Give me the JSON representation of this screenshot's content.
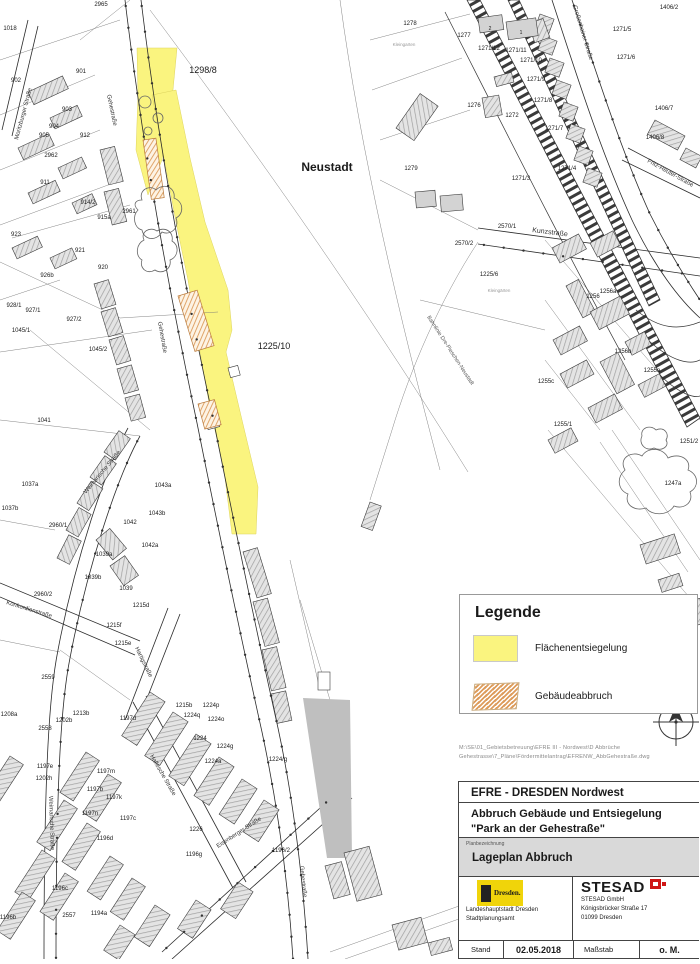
{
  "colors": {
    "yellow": "#FAF47F",
    "orange": "#DD9C5C",
    "red": "#CF1615",
    "building_gray": "#D3D3D3",
    "solid_gray": "#BFBFBF",
    "dresden_yellow": "#F0D40A"
  },
  "legend": {
    "title": "Legende",
    "items": [
      {
        "label": "Flächenentsiegelung",
        "swatch": "yellow-fill"
      },
      {
        "label": "Gebäudeabbruch",
        "swatch": "orange-hatch"
      }
    ]
  },
  "file_path": {
    "line1": "M:\\SE\\01_Gebietsbetreuung\\EFRE III - Nordwest\\D Abbrüche",
    "line2": "Gehestrasse\\7_Pläne\\Fördermittelantrag\\EFRENW_AbbGehestraße.dwg"
  },
  "title_block": {
    "project": "EFRE - DRESDEN Nordwest",
    "subject_line1": "Abbruch Gebäude und Entsiegelung",
    "subject_line2": "\"Park an der Gehestraße\"",
    "plan_caption": "Planbezeichnung",
    "plan_name": "Lageplan Abbruch",
    "dresden_logo_text": "Dresden.",
    "client_line1": "Landeshauptstadt Dresden",
    "client_line2": "Stadtplanungsamt",
    "company_logo": "STESAD",
    "company_line1": "STESAD GmbH",
    "company_line2": "Königsbrücker Straße 17",
    "company_line3": "01099 Dresden",
    "date_label": "Stand",
    "date": "02.05.2018",
    "scale_label": "Maßstab",
    "scale": "o. M."
  },
  "map": {
    "labels": [
      {
        "t": "Neustadt",
        "x": 327,
        "y": 171,
        "s": 12,
        "b": 1
      },
      {
        "t": "1298/8",
        "x": 203,
        "y": 73,
        "s": 9
      },
      {
        "t": "1225/10",
        "x": 274,
        "y": 349,
        "s": 9
      },
      {
        "t": "2965",
        "x": 101,
        "y": 6
      },
      {
        "t": "1018",
        "x": 10,
        "y": 30
      },
      {
        "t": "901",
        "x": 81,
        "y": 73
      },
      {
        "t": "902",
        "x": 16,
        "y": 82
      },
      {
        "t": "903",
        "x": 67,
        "y": 111
      },
      {
        "t": "904",
        "x": 54,
        "y": 128
      },
      {
        "t": "905",
        "x": 44,
        "y": 137
      },
      {
        "t": "912",
        "x": 85,
        "y": 137
      },
      {
        "t": "2962",
        "x": 51,
        "y": 157
      },
      {
        "t": "911",
        "x": 45,
        "y": 184
      },
      {
        "t": "914/2",
        "x": 88,
        "y": 204
      },
      {
        "t": "915a",
        "x": 104,
        "y": 219
      },
      {
        "t": "2961",
        "x": 129,
        "y": 213
      },
      {
        "t": "923",
        "x": 16,
        "y": 236
      },
      {
        "t": "921",
        "x": 80,
        "y": 252
      },
      {
        "t": "920",
        "x": 103,
        "y": 269
      },
      {
        "t": "926b",
        "x": 47,
        "y": 277
      },
      {
        "t": "928/1",
        "x": 14,
        "y": 307
      },
      {
        "t": "927/1",
        "x": 33,
        "y": 312
      },
      {
        "t": "927/2",
        "x": 74,
        "y": 321
      },
      {
        "t": "1045/1",
        "x": 21,
        "y": 332
      },
      {
        "t": "1045/2",
        "x": 98,
        "y": 351
      },
      {
        "t": "1041",
        "x": 44,
        "y": 422
      },
      {
        "t": "1037a",
        "x": 30,
        "y": 486
      },
      {
        "t": "1037b",
        "x": 10,
        "y": 510
      },
      {
        "t": "2960/1",
        "x": 58,
        "y": 527
      },
      {
        "t": "1042",
        "x": 130,
        "y": 524
      },
      {
        "t": "1043a",
        "x": 163,
        "y": 487
      },
      {
        "t": "1043b",
        "x": 157,
        "y": 515
      },
      {
        "t": "1042a",
        "x": 150,
        "y": 547
      },
      {
        "t": "1039a",
        "x": 104,
        "y": 556
      },
      {
        "t": "1039b",
        "x": 93,
        "y": 579
      },
      {
        "t": "1039",
        "x": 126,
        "y": 590
      },
      {
        "t": "2960/2",
        "x": 43,
        "y": 596
      },
      {
        "t": "1215d",
        "x": 141,
        "y": 607
      },
      {
        "t": "1215f",
        "x": 114,
        "y": 627
      },
      {
        "t": "1215e",
        "x": 123,
        "y": 645
      },
      {
        "t": "2559",
        "x": 48,
        "y": 679
      },
      {
        "t": "1215b",
        "x": 184,
        "y": 707
      },
      {
        "t": "1224q",
        "x": 192,
        "y": 717
      },
      {
        "t": "1224p",
        "x": 211,
        "y": 707
      },
      {
        "t": "1224o",
        "x": 216,
        "y": 721
      },
      {
        "t": "1224",
        "x": 200,
        "y": 740
      },
      {
        "t": "1224g",
        "x": 225,
        "y": 748
      },
      {
        "t": "1224a",
        "x": 213,
        "y": 763
      },
      {
        "t": "1224/g",
        "x": 278,
        "y": 761
      },
      {
        "t": "1197d",
        "x": 128,
        "y": 720
      },
      {
        "t": "1197c",
        "x": 128,
        "y": 820
      },
      {
        "t": "1226",
        "x": 196,
        "y": 831
      },
      {
        "t": "1196g",
        "x": 194,
        "y": 856
      },
      {
        "t": "1196/2",
        "x": 281,
        "y": 852
      },
      {
        "t": "1208a",
        "x": 9,
        "y": 716
      },
      {
        "t": "1213b",
        "x": 81,
        "y": 715
      },
      {
        "t": "1202b",
        "x": 64,
        "y": 722
      },
      {
        "t": "2558",
        "x": 45,
        "y": 730
      },
      {
        "t": "1197e",
        "x": 45,
        "y": 768
      },
      {
        "t": "1202h",
        "x": 44,
        "y": 780
      },
      {
        "t": "1197m",
        "x": 106,
        "y": 773
      },
      {
        "t": "1197b",
        "x": 95,
        "y": 791
      },
      {
        "t": "1197k",
        "x": 114,
        "y": 799
      },
      {
        "t": "1197n",
        "x": 90,
        "y": 815
      },
      {
        "t": "1196d",
        "x": 105,
        "y": 840
      },
      {
        "t": "1196c",
        "x": 60,
        "y": 890
      },
      {
        "t": "2557",
        "x": 69,
        "y": 917
      },
      {
        "t": "1194a",
        "x": 99,
        "y": 915
      },
      {
        "t": "1196b",
        "x": 8,
        "y": 919
      },
      {
        "t": "1278",
        "x": 410,
        "y": 25
      },
      {
        "t": "1277",
        "x": 464,
        "y": 37
      },
      {
        "t": "1271/12",
        "x": 489,
        "y": 50
      },
      {
        "t": "1271/11",
        "x": 516,
        "y": 52
      },
      {
        "t": "1271/10",
        "x": 531,
        "y": 62
      },
      {
        "t": "1271/9",
        "x": 536,
        "y": 81
      },
      {
        "t": "1271/8",
        "x": 543,
        "y": 102
      },
      {
        "t": "1276",
        "x": 474,
        "y": 107
      },
      {
        "t": "1272",
        "x": 512,
        "y": 117
      },
      {
        "t": "1279",
        "x": 411,
        "y": 170
      },
      {
        "t": "1271/3",
        "x": 521,
        "y": 180
      },
      {
        "t": "2570/1",
        "x": 507,
        "y": 228
      },
      {
        "t": "2570/2",
        "x": 464,
        "y": 245
      },
      {
        "t": "1225/6",
        "x": 489,
        "y": 276
      },
      {
        "t": "1271/5",
        "x": 622,
        "y": 31
      },
      {
        "t": "1271/6",
        "x": 626,
        "y": 59
      },
      {
        "t": "1271/7",
        "x": 554,
        "y": 130
      },
      {
        "t": "1271/4",
        "x": 567,
        "y": 170
      },
      {
        "t": "1406/2",
        "x": 669,
        "y": 9
      },
      {
        "t": "1406/7",
        "x": 664,
        "y": 110
      },
      {
        "t": "1406/8",
        "x": 655,
        "y": 139
      },
      {
        "t": "1256a",
        "x": 608,
        "y": 293
      },
      {
        "t": "1256",
        "x": 593,
        "y": 298
      },
      {
        "t": "1256b",
        "x": 623,
        "y": 353
      },
      {
        "t": "1255a",
        "x": 652,
        "y": 372
      },
      {
        "t": "1255c",
        "x": 546,
        "y": 383
      },
      {
        "t": "1255/1",
        "x": 563,
        "y": 426
      },
      {
        "t": "1251/2",
        "x": 689,
        "y": 443
      },
      {
        "t": "1247a",
        "x": 673,
        "y": 485
      },
      {
        "t": "2",
        "x": 490,
        "y": 30,
        "s": 5
      },
      {
        "t": "1",
        "x": 521,
        "y": 34,
        "s": 5
      },
      {
        "t": "Kleingarten",
        "x": 404,
        "y": 46,
        "s": 4.5,
        "c": "#999"
      },
      {
        "t": "Kleingärten",
        "x": 499,
        "y": 292,
        "s": 4.5,
        "c": "#999"
      },
      {
        "t": "Gehestraße",
        "x": 107,
        "y": 95,
        "r": 78,
        "a": "start",
        "c": "#333"
      },
      {
        "t": "Gehestraße",
        "x": 158,
        "y": 322,
        "r": 80,
        "a": "start",
        "c": "#333"
      },
      {
        "t": "Gehestraße",
        "x": 300,
        "y": 866,
        "r": 84,
        "a": "start",
        "c": "#333"
      },
      {
        "t": "Weimarische Straße",
        "x": 86,
        "y": 494,
        "r": -50,
        "a": "start",
        "c": "#333"
      },
      {
        "t": "Weimarische Straße",
        "x": 49,
        "y": 796,
        "r": 88,
        "a": "start",
        "c": "#333"
      },
      {
        "t": "Moritzburger Straße",
        "x": 18,
        "y": 140,
        "r": -75,
        "a": "start",
        "c": "#333"
      },
      {
        "t": "Konkordienstraße",
        "x": 6,
        "y": 604,
        "r": 17,
        "a": "start",
        "c": "#333"
      },
      {
        "t": "Hartigstraße",
        "x": 135,
        "y": 648,
        "r": 64,
        "a": "start",
        "c": "#333"
      },
      {
        "t": "Hallesche Straße",
        "x": 150,
        "y": 756,
        "r": 60,
        "a": "start",
        "c": "#333"
      },
      {
        "t": "Eisenberger Straße",
        "x": 218,
        "y": 848,
        "r": -33,
        "a": "start",
        "c": "#333"
      },
      {
        "t": "Kunzstraße",
        "x": 532,
        "y": 232,
        "r": 7,
        "s": 7,
        "a": "start",
        "c": "#333"
      },
      {
        "t": "Großenhainer Straße",
        "x": 573,
        "y": 6,
        "r": 73,
        "a": "start",
        "c": "#333"
      },
      {
        "t": "Fritz-Reuter-Straße",
        "x": 647,
        "y": 162,
        "r": 29,
        "a": "start",
        "c": "#333"
      },
      {
        "t": "Bahnlinie Dre-Pieschen-Neustadt",
        "x": 427,
        "y": 317,
        "r": 57,
        "s": 5.5,
        "a": "start",
        "c": "#555"
      }
    ]
  }
}
